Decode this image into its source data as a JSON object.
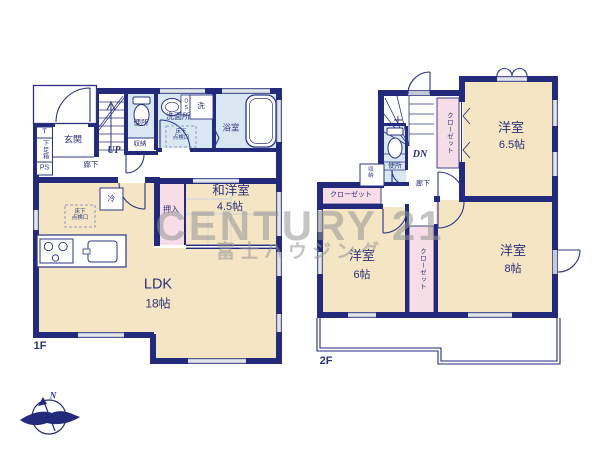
{
  "watermark": {
    "brand": "CENTURY 21",
    "company": "富士ハウジング"
  },
  "compass": {
    "north": "N"
  },
  "floor1": {
    "label": "1F",
    "entrance": "玄関",
    "t_box": "T",
    "shoe_box": "下足箱",
    "pipe_space": "PS",
    "stairs_up": "UP",
    "hallway": "廊下",
    "toilet": "便所",
    "toilet_storage": "収納",
    "washroom": "洗面所",
    "duct_space": "DS",
    "washer_pan": "洗",
    "floor_hatch_line1": "床下",
    "floor_hatch_line2": "点検口",
    "bathroom": "浴室",
    "japanese_room_name": "和洋室",
    "japanese_room_size": "4.5帖",
    "oshiire": "押入",
    "fridge": "冷",
    "ldk_name": "LDK",
    "ldk_size": "18帖"
  },
  "floor2": {
    "label": "2F",
    "stairs_down": "DN",
    "closet_a": "クローゼット",
    "closet_b": "クローゼット",
    "closet_c": "クローゼット",
    "toilet": "便所",
    "storage": "収納",
    "hallway": "廊下",
    "room_65_name": "洋室",
    "room_65_size": "6.5帖",
    "room_6_name": "洋室",
    "room_6_size": "6帖",
    "room_8_name": "洋室",
    "room_8_size": "8帖"
  },
  "colors": {
    "wall_navy": "#232a7c",
    "room_beige": "#f4e6c5",
    "wet_area_blue": "#d9e7f3",
    "closet_pink": "#f7dee6",
    "window_gray": "#c3c9d5",
    "label_navy": "#2b3178",
    "watermark_gray": "#949494"
  }
}
